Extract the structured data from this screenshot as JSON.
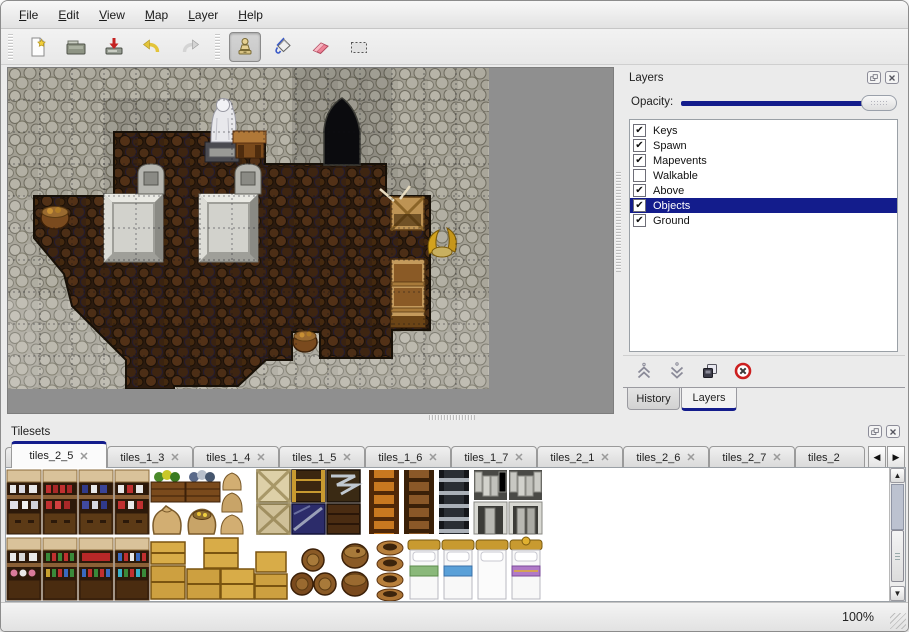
{
  "window": {
    "accent_color": "#131c8c",
    "chrome_color": "#ebebeb"
  },
  "menu_bar": {
    "items": [
      {
        "label": "File"
      },
      {
        "label": "Edit"
      },
      {
        "label": "View"
      },
      {
        "label": "Map"
      },
      {
        "label": "Layer"
      },
      {
        "label": "Help"
      }
    ]
  },
  "toolbar": {
    "buttons": [
      {
        "name": "new-map",
        "icon": "new-file-icon",
        "active": false
      },
      {
        "name": "open-map",
        "icon": "open-folder-icon",
        "active": false
      },
      {
        "name": "save-map",
        "icon": "save-icon",
        "active": false
      },
      {
        "name": "undo",
        "icon": "undo-arrow-icon",
        "active": false
      },
      {
        "name": "redo",
        "icon": "redo-arrow-icon",
        "active": false
      },
      {
        "name": "stamp-tool",
        "icon": "stamp-icon",
        "active": true
      },
      {
        "name": "fill-tool",
        "icon": "paint-bucket-icon",
        "active": false
      },
      {
        "name": "eraser-tool",
        "icon": "eraser-icon",
        "active": false
      },
      {
        "name": "select-tool",
        "icon": "selection-rect-icon",
        "active": false
      }
    ]
  },
  "map_view": {
    "grid_size": 32,
    "objects": [
      "stone-cave-walls",
      "dark-scale-floor",
      "cave-entrance",
      "white-statue",
      "wooden-table",
      "gravestone-left",
      "gravestone-right",
      "stone-slab-left",
      "stone-slab-right",
      "basket-left",
      "broken-crate",
      "golden-horns",
      "wooden-shelf",
      "basket-bottom"
    ]
  },
  "layers_panel": {
    "title": "Layers",
    "opacity_label": "Opacity:",
    "opacity_percent": 100,
    "layers": [
      {
        "name": "Keys",
        "check": "✔",
        "selected": false
      },
      {
        "name": "Spawn",
        "check": "✔",
        "selected": false
      },
      {
        "name": "Mapevents",
        "check": "✔",
        "selected": false
      },
      {
        "name": "Walkable",
        "check": "",
        "selected": false
      },
      {
        "name": "Above",
        "check": "✔",
        "selected": false
      },
      {
        "name": "Objects",
        "check": "✔",
        "selected": true
      },
      {
        "name": "Ground",
        "check": "✔",
        "selected": false
      }
    ],
    "buttons": [
      "move-layer-up",
      "move-layer-down",
      "duplicate-layer",
      "delete-layer"
    ],
    "dock_tabs": [
      {
        "label": "History",
        "active": false
      },
      {
        "label": "Layers",
        "active": true
      }
    ]
  },
  "tilesets_panel": {
    "title": "Tilesets",
    "close_glyph": "✕",
    "scroll_left_glyph": "◀",
    "scroll_right_glyph": "▶",
    "tabs": [
      {
        "label": "tiles_2_5",
        "active": true
      },
      {
        "label": "tiles_1_3",
        "active": false
      },
      {
        "label": "tiles_1_4",
        "active": false
      },
      {
        "label": "tiles_1_5",
        "active": false
      },
      {
        "label": "tiles_1_6",
        "active": false
      },
      {
        "label": "tiles_1_7",
        "active": false
      },
      {
        "label": "tiles_2_1",
        "active": false
      },
      {
        "label": "tiles_2_6",
        "active": false
      },
      {
        "label": "tiles_2_7",
        "active": false
      },
      {
        "label": "tiles_2",
        "active": false
      }
    ],
    "tiles": [
      "shelf-dishes",
      "shelf-red-bottles",
      "shelf-blue-jars",
      "shelf-jugs",
      "planter-green",
      "planter-blue",
      "sack-large",
      "sack-open-gold",
      "sack-stack",
      "crate-x-light",
      "crate-x-light-2",
      "crate-dark-gold",
      "crate-navy",
      "crate-iron-brace",
      "crate-dark",
      "ladder-orange",
      "ladder-brown",
      "ladder-iron",
      "stone-arch-1",
      "stone-arch-2",
      "shelf-jars-2",
      "shelf-green-red",
      "shelf-red-rows",
      "shelf-mixed-bottles",
      "crates-yellow",
      "barrel-pile",
      "barrels-stacked",
      "pot-stack",
      "bed-green",
      "bed-blue",
      "bed-white",
      "bed-purple"
    ]
  },
  "status_bar": {
    "zoom_level": "100%"
  }
}
